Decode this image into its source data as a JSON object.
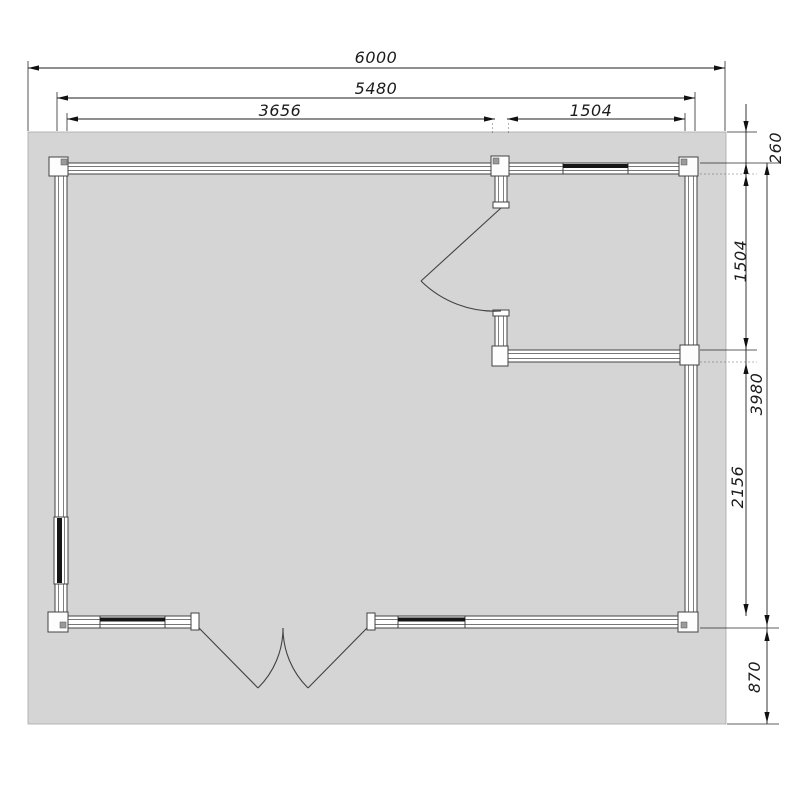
{
  "drawing": {
    "type_label": "floor-plan",
    "dims": {
      "overall_width": "6000",
      "building_width": "5480",
      "left_section_width": "3656",
      "right_section_width": "1504",
      "front_offset": "260",
      "right_room_depth": "1504",
      "building_depth": "3980",
      "main_room_depth": "2156",
      "terrace_depth": "870"
    },
    "colors": {
      "deck": "#d5d5d5",
      "wall_fill": "#ffffff",
      "line": "#424242",
      "dim_line": "#1f1f1f",
      "window_glass": "#161616"
    }
  }
}
